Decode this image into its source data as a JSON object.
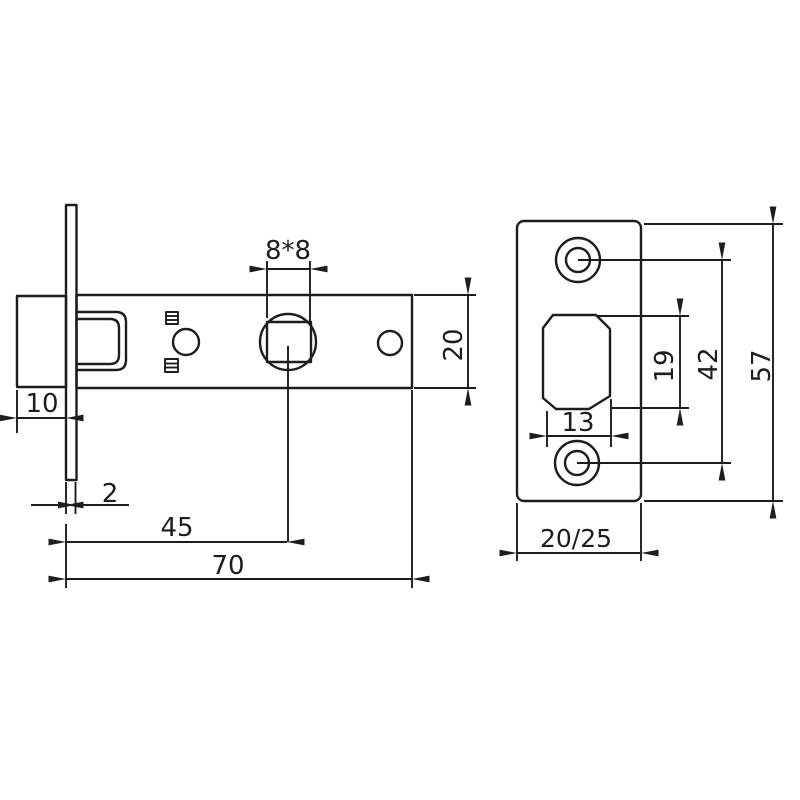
{
  "drawing": {
    "views": {
      "latch_body": {
        "dimensions": {
          "spindle_square": "8*8",
          "bolt_protrusion": "10",
          "faceplate_thickness": "2",
          "backset": "45",
          "case_length": "70",
          "case_height": "20"
        }
      },
      "strike_plate": {
        "dimensions": {
          "latch_hole_height": "19",
          "screw_spacing": "42",
          "plate_height": "57",
          "latch_hole_width": "13",
          "plate_width": "20/25"
        }
      }
    },
    "colors": {
      "line": "#1d1d1d",
      "background": "#ffffff"
    }
  }
}
